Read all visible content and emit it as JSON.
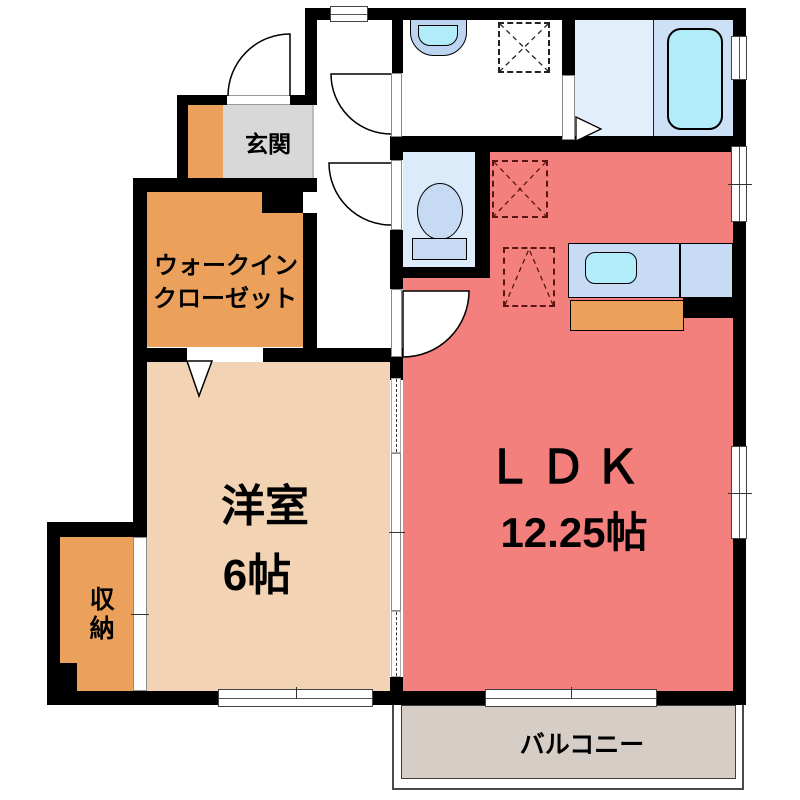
{
  "rooms": {
    "genkan": {
      "label": "玄関"
    },
    "walk_in_closet": {
      "line1": "ウォークイン",
      "line2": "クローゼット"
    },
    "western_room": {
      "name": "洋室",
      "size": "6帖"
    },
    "storage": {
      "label": "収納"
    },
    "ldk": {
      "name": "ＬＤＫ",
      "size": "12.25帖"
    },
    "balcony": {
      "label": "バルコニー"
    }
  },
  "fixtures": [
    "bathtub",
    "wash-basin",
    "washing-machine-space",
    "toilet",
    "kitchen-sink",
    "kitchen-counter",
    "refrigerator-space",
    "appliance-space"
  ],
  "colors": {
    "wall": "#000000",
    "ldk_fill": "#f4807e",
    "western_room_fill": "#f2d4b5",
    "closet_orange": "#eba05c",
    "genkan_gray": "#d8d8d8",
    "balcony_gray": "#d6cec6",
    "bathroom_floor": "#e2effa",
    "bathtub_zone": "#cde1f6",
    "water_cyan": "#b2ecf8",
    "fixture_blue": "#c7daf4",
    "counter_blue": "#c7dcf4"
  }
}
